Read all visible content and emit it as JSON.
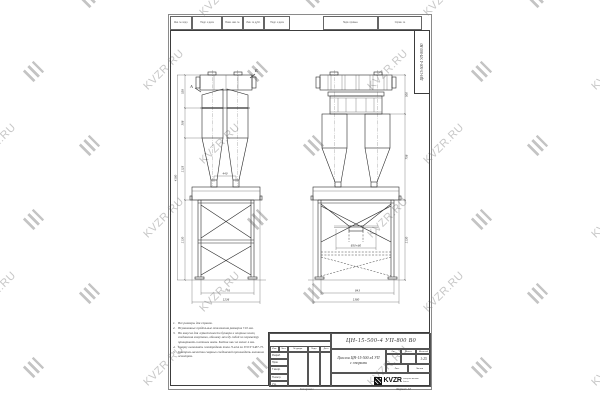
{
  "watermark": {
    "text": "KVZR.RU",
    "color": "#c7c7c7"
  },
  "colors": {
    "line": "#2b2b2b",
    "watermark": "#c7c7c7",
    "logo": "#111111"
  },
  "sheet": {
    "top_strip_cells": [
      "Инв. № подл.",
      "Подп. и дата",
      "Взам. инв. №",
      "Инв. № дубл.",
      "Подп. и дата",
      "Перв. примен.",
      "Справ. №"
    ],
    "side_stamp": "ЦН-15-500-4 УП-800  В0"
  },
  "notes": {
    "items": [
      {
        "n": "1.",
        "text": "Все размеры для справок."
      },
      {
        "n": "2.",
        "text": "Неуказанные предельные отклонения размеров ±10 мм."
      },
      {
        "n": "3.",
        "text": "На конусах для герметичности бункера и опорных колец соединения хомутами, обшивку между собой по периметру приваривать плотным швом. Клёпка шаг не менее 4 мм."
      },
      {
        "n": "4.",
        "text": "Сварку выполнять электродами типа Э-42А по ГОСТ 9467-75."
      },
      {
        "n": "5.",
        "text": "Контроль качества сварных соединений производить внешним осмотром."
      }
    ]
  },
  "views": {
    "left": {
      "section_label_a": "А",
      "section_label_b": "Б",
      "dim_outlets": "440",
      "dims_left_chain": [
        "528",
        "308",
        "1125",
        "1130"
      ],
      "dim_total_height": "4180",
      "dims_bottom": [
        "776",
        "1236"
      ]
    },
    "right": {
      "dim_hopper": "850×60",
      "dims_right_chain": [
        "500",
        "758",
        "1130"
      ],
      "dims_bottom": [
        "843",
        "1380"
      ]
    }
  },
  "title_block": {
    "doc_number": "ЦН-15-500-4 УП-800  В0",
    "title_line1": "Циклон ЦН-15-500 х4 УП",
    "title_line2": "с опорами",
    "col_izm": "Изм.",
    "col_list": "Лист",
    "col_doc": "№ докум.",
    "col_podp": "Подп.",
    "col_data": "Дата",
    "rows": [
      "Разраб.",
      "Пров.",
      "Т.контр.",
      "Н.контр.",
      "Утв."
    ],
    "lit_label": "Лит.",
    "mass_label": "Масса",
    "scale_label": "Масштаб",
    "scale_value": "1:25",
    "sheet_label": "Лист",
    "sheets_label": "Листов",
    "logo_text": "KVZR",
    "logo_sub1": "интернет-магазин",
    "logo_sub2": "kvzr.ru",
    "copied_label": "Копировал",
    "format_label": "Формат А3"
  }
}
